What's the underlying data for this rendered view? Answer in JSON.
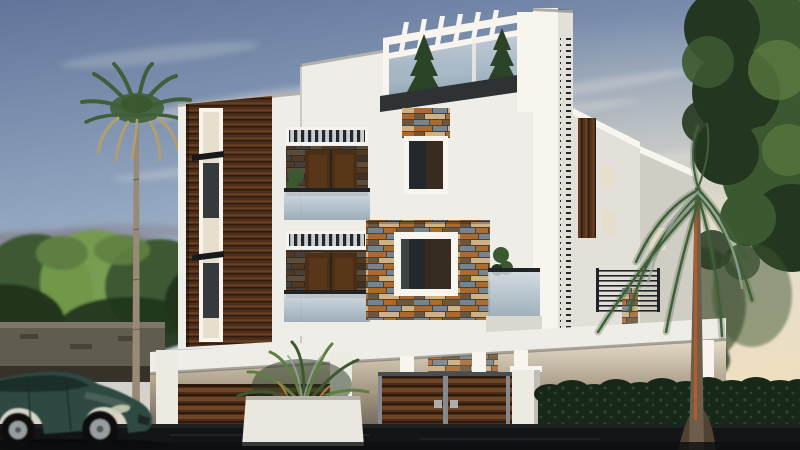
{
  "window": {
    "width": 800,
    "height": 450
  },
  "scene": {
    "type": "architectural-exterior-render",
    "alt": "3D render of a modern three-storey white villa with dark wood slat panels, stone feature wall, glass balconies and rooftop pergola at dusk; fan palm and leafy trees around, wooden gates, white planter, trimmed hedge, tall palm on the right and a dark green sedan passing on the road",
    "elements": [
      "sky",
      "clouds",
      "left-fan-palm",
      "background-trees",
      "right-canopy-tree",
      "villa",
      "rooftop-pergola",
      "rooftop-glass-railing",
      "conifer-planters",
      "wood-slat-panel",
      "balcony-2f",
      "balcony-1f",
      "stone-feature-wall",
      "feature-window",
      "side-elevation",
      "ground-floor-porch",
      "porch-columns",
      "left-wooden-gate",
      "main-double-gate",
      "white-planter-box",
      "gate-pillar",
      "hedge",
      "tall-right-palm",
      "compound-wall",
      "road",
      "sedan-car"
    ]
  },
  "colors": {
    "sky_top": "#61759a",
    "sky_mid": "#96a9c2",
    "sky_light": "#c2ccd8",
    "sky_warm": "#e9d9ba",
    "sky_horizon_glow": "#f4e6c8",
    "cloud": "#e8e6e1",
    "cloud_dusk": "#83828e",
    "cloud_pink": "#bfa294",
    "building_white": "#efede7",
    "building_white_bright": "#f8f5ee",
    "building_shade": "#d9d7cf",
    "building_side": "#e2e0d8",
    "building_side_dark": "#d0cec4",
    "fascia_dark": "#2e3234",
    "wood_dark": "#311d0f",
    "wood_mid": "#54321c",
    "wood_light": "#7b4d29",
    "glass_top": "#ccd7de",
    "glass_bottom": "#8fa4b2",
    "louver_dark": "#24272a",
    "vent_bg": "#c9ced2",
    "door_wood": "#4c2e15",
    "door_wood_light": "#6e4423",
    "recess_dark": "#2b221a",
    "window_glass": "#23282c",
    "stone_rust": "#ad6a2f",
    "stone_slate": "#76848f",
    "stone_cream": "#cfb184",
    "stone_brown": "#6b573f",
    "stone_dark": "#45433e",
    "cream_wall": "#e7decb",
    "porch_shadow": "#a89b86",
    "porch_dark": "#6e655a",
    "gate_wood": "#4a2c17",
    "gate_wood_light": "#6e4526",
    "gate_wood_dark": "#2e1a0c",
    "gate_frame": "#85898d",
    "pillar_white": "#edeae2",
    "planter_white": "#e9e7df",
    "pot_brown": "#59452f",
    "hedge_dark": "#182818",
    "hedge_light": "#31502c",
    "tree_dark": "#23361f",
    "tree_mid": "#3c5830",
    "tree_light": "#5f7f42",
    "tree_bright": "#749c4c",
    "conifer": "#2d4328",
    "plant_accent": "#b08040",
    "palm_green": "#3f5f38",
    "palm_silver": "#93a998",
    "palm_dry": "#b29e6e",
    "palm_trunk": "#978b77",
    "palm_trunk_right": "#6e5d49",
    "palm_stripe": "#b25c2e",
    "wall_stone": "#615c50",
    "wall_stone_light": "#7d776a",
    "wall_dark": "#36322a",
    "road": "#131416",
    "road_light": "#27292c",
    "metal_dark": "#202326",
    "car_body": "#2e4a42",
    "car_body_light": "#55695f",
    "car_window": "#1f2d2a",
    "car_alloy": "#979ea2",
    "headlight": "#c9cdb5"
  }
}
